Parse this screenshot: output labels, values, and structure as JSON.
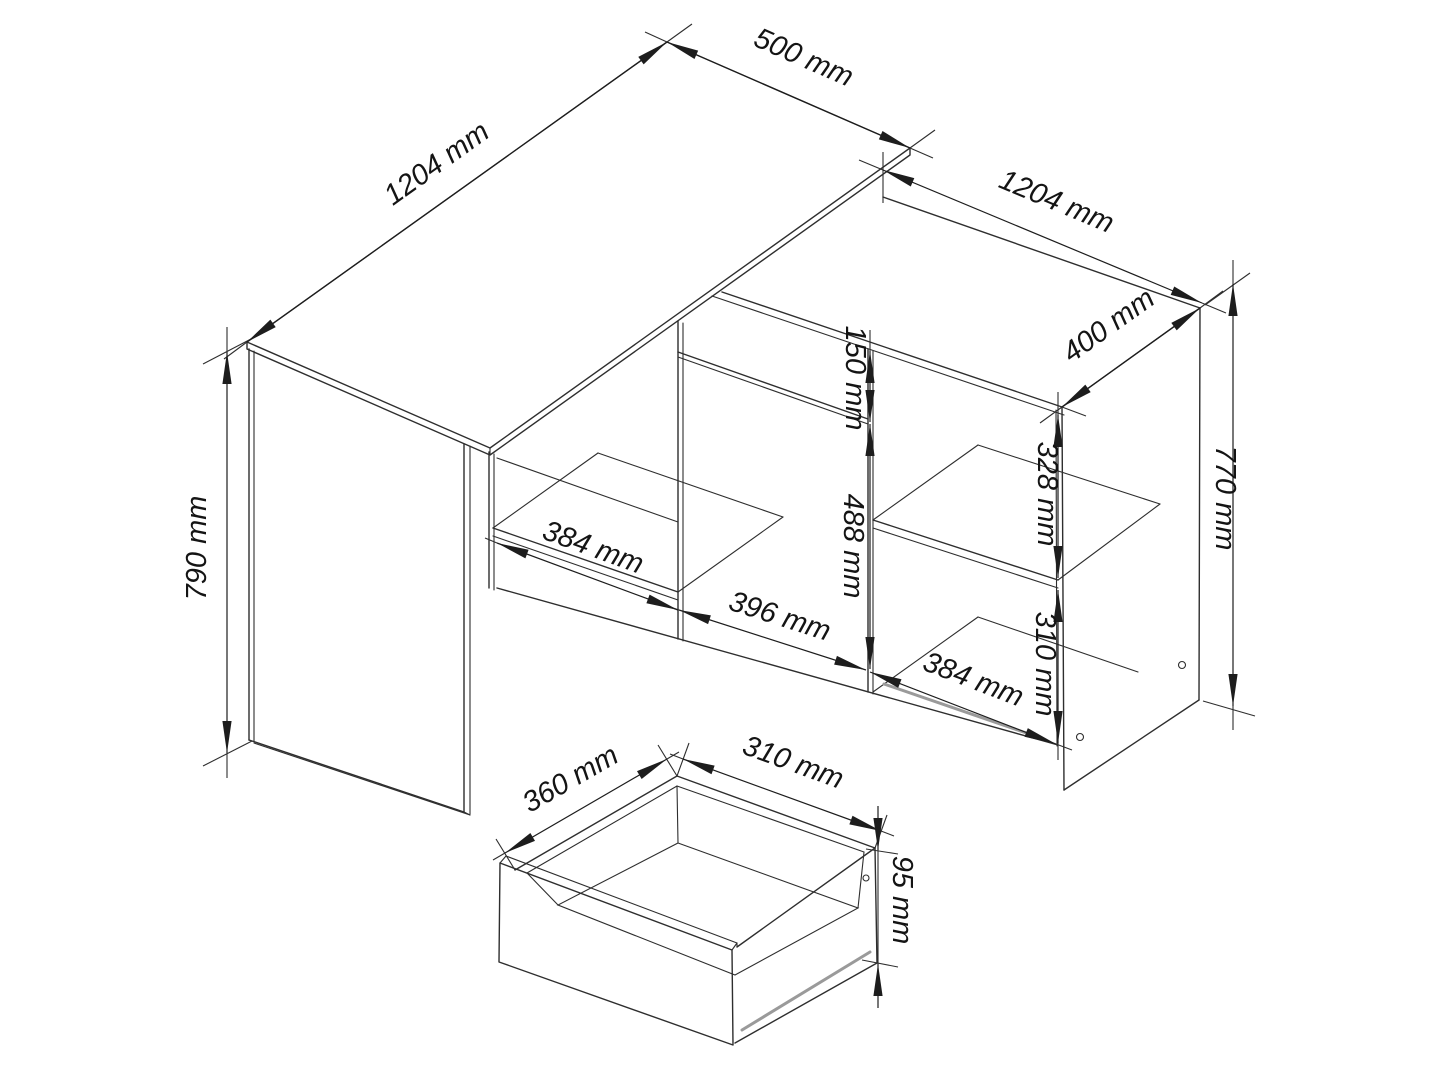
{
  "drawing": {
    "kind": "furniture technical drawing",
    "subject": "corner desk with cabinet and drawer detail",
    "background": "#ffffff",
    "line_color": "#2e2e2e",
    "accent_gray": "#9a9a9a",
    "text_color": "#141414",
    "unit": "mm"
  },
  "dims": [
    {
      "name": "desktop-length",
      "label": "1204 mm"
    },
    {
      "name": "desktop-depth",
      "label": "500 mm"
    },
    {
      "name": "cabinet-length",
      "label": "1204 mm"
    },
    {
      "name": "cabinet-depth",
      "label": "400 mm"
    },
    {
      "name": "cabinet-height",
      "label": "770 mm"
    },
    {
      "name": "desk-height",
      "label": "790 mm"
    },
    {
      "name": "drawer-front-height",
      "label": "150 mm"
    },
    {
      "name": "door-height",
      "label": "488 mm"
    },
    {
      "name": "upper-right-compartment",
      "label": "328 mm"
    },
    {
      "name": "lower-right-compartment",
      "label": "310 mm"
    },
    {
      "name": "left-compartment-width",
      "label": "384 mm"
    },
    {
      "name": "door-width",
      "label": "396 mm"
    },
    {
      "name": "right-compartment-width",
      "label": "384 mm"
    },
    {
      "name": "drawer-depth",
      "label": "360 mm"
    },
    {
      "name": "drawer-width",
      "label": "310 mm"
    },
    {
      "name": "drawer-side-height",
      "label": "95 mm"
    }
  ]
}
